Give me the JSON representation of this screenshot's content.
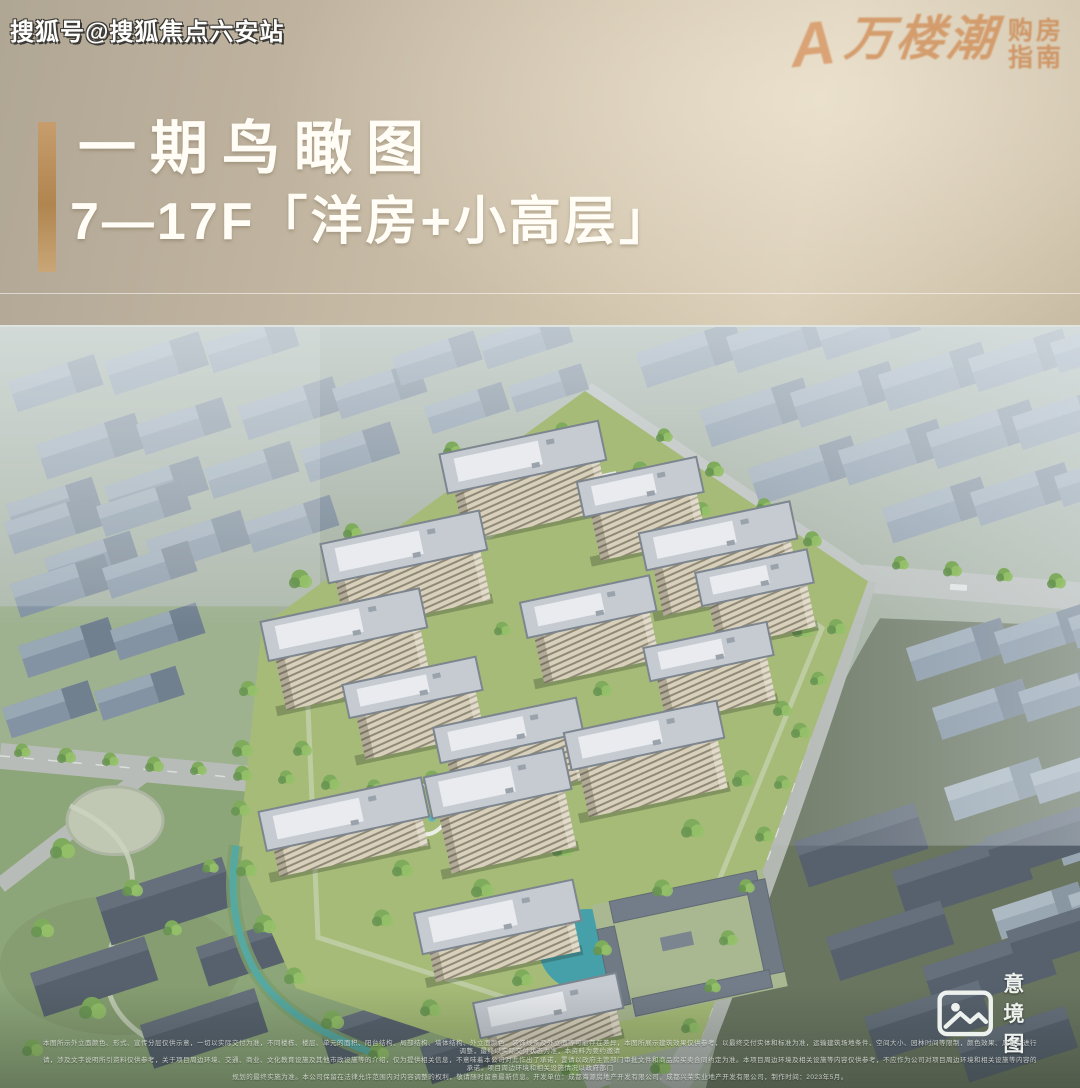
{
  "watermark": {
    "text": "搜狐号@搜狐焦点六安站"
  },
  "logo": {
    "brand_mark": "A",
    "brand_glyphs": "万楼潮",
    "tagline_line1": "购房",
    "tagline_line2": "指南"
  },
  "header": {
    "title": "一期鸟瞰图",
    "subtitle": "7—17F「洋房+小高层」"
  },
  "hero": {
    "caption": "意境图",
    "caption_icon": "image-icon"
  },
  "disclaimer": {
    "line1": "本图所示外立面颜色、形式、宣传分层仅供示意，一切以实际交付为准，不同楼栋、楼层、单元的面积、阳台结构、局部结构、墙体结构、外立面颜色、装饰线条及外立面等可能存在差异，本图所展示建筑效果仅供参考，以最终交付实体和标准为准，运输建筑场地条件、空间大小、园林时间等限制，颜色效果、风格会进行调整，最终以实际交付状态为准，本资料为要约邀请",
    "line2": "请，涉及文字说明所引资料仅供参考，关于项目周边环境、交通、商业、文化教育设施及其他市政设施等的介绍，仅为提供相关信息，不意味着本公司对此作出了承诺，置请以政府主管部门审批文件和商品房买卖合同约定为准。本项目周边环境及相关设施等内容仅供参考，不应作为公司对项目周边环境和相关设施等内容的承诺，项目周边环境和相关设施情况以政府部门",
    "line3": "规划的最终实施为准。本公司保留在法律允许范围内对内容调整的权利，敬请随时留意最新信息。开发单位：成都海源房地产开发有限公司、成都兴荣实业地产开发有限公司，制作时间：2023年5月。"
  },
  "colors": {
    "accent_gold": "#b88a55",
    "logo_copper": "#d2925f",
    "header_bg_light": "#d9cdb6",
    "header_bg_dark": "#b0a694",
    "pond_teal": "#45a6ab",
    "tower_facade": "#dbd2ba",
    "context_gray_blue": "#8191a1"
  }
}
